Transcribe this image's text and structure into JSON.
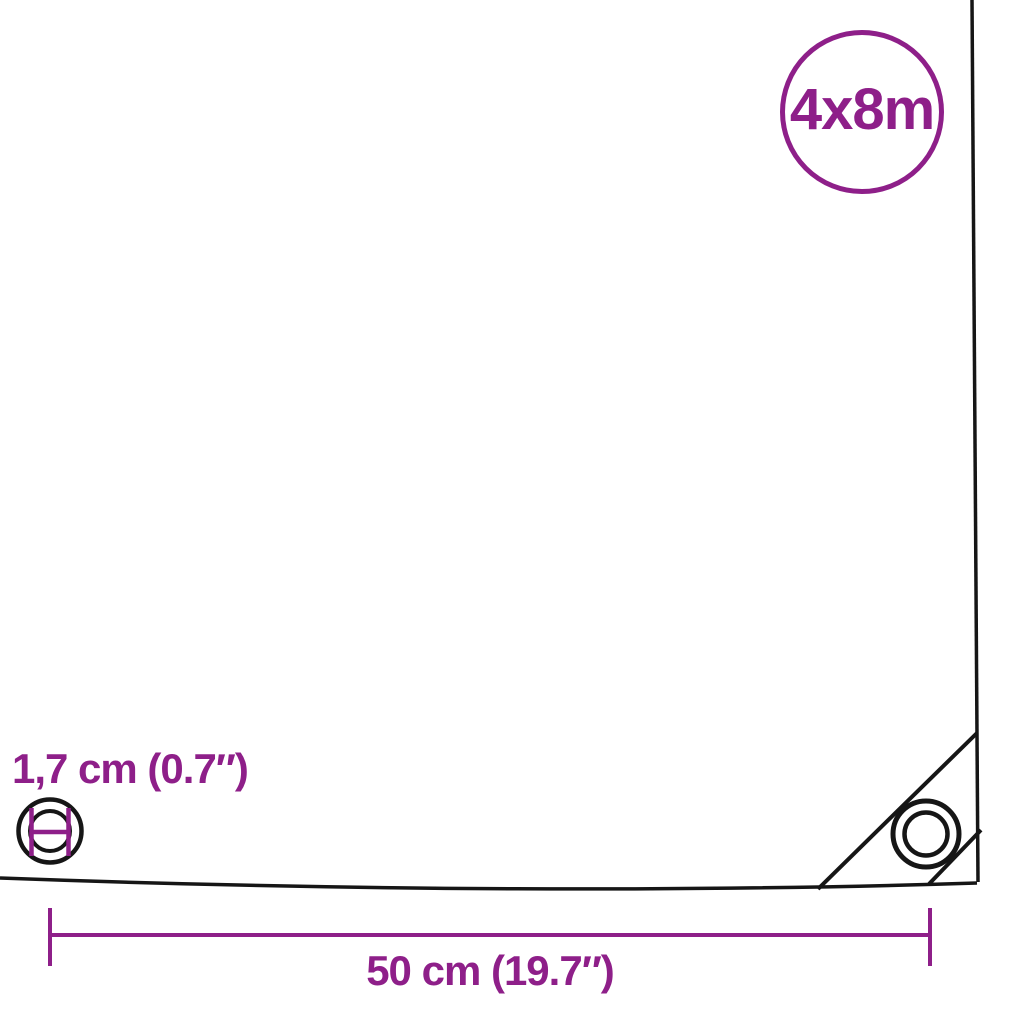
{
  "diagram": {
    "kind": "product-dimension-diagram",
    "size_badge": {
      "label": "4x8m"
    },
    "measurements": {
      "grommet_diameter_label": "1,7 cm (0.7″)",
      "grommet_spacing_label": "50 cm (19.7″)"
    },
    "icons": {
      "size_badge": "circle-outline-badge",
      "grommet_diameter": "grommet-ring-with-diameter-marks",
      "corner_grommet": "double-ring-eyelet",
      "dimension_line": "horizontal-line-with-end-ticks"
    }
  },
  "colors": {
    "accent_purple": "#8E1F89",
    "line_black": "#161616",
    "background": "#FFFFFF"
  }
}
